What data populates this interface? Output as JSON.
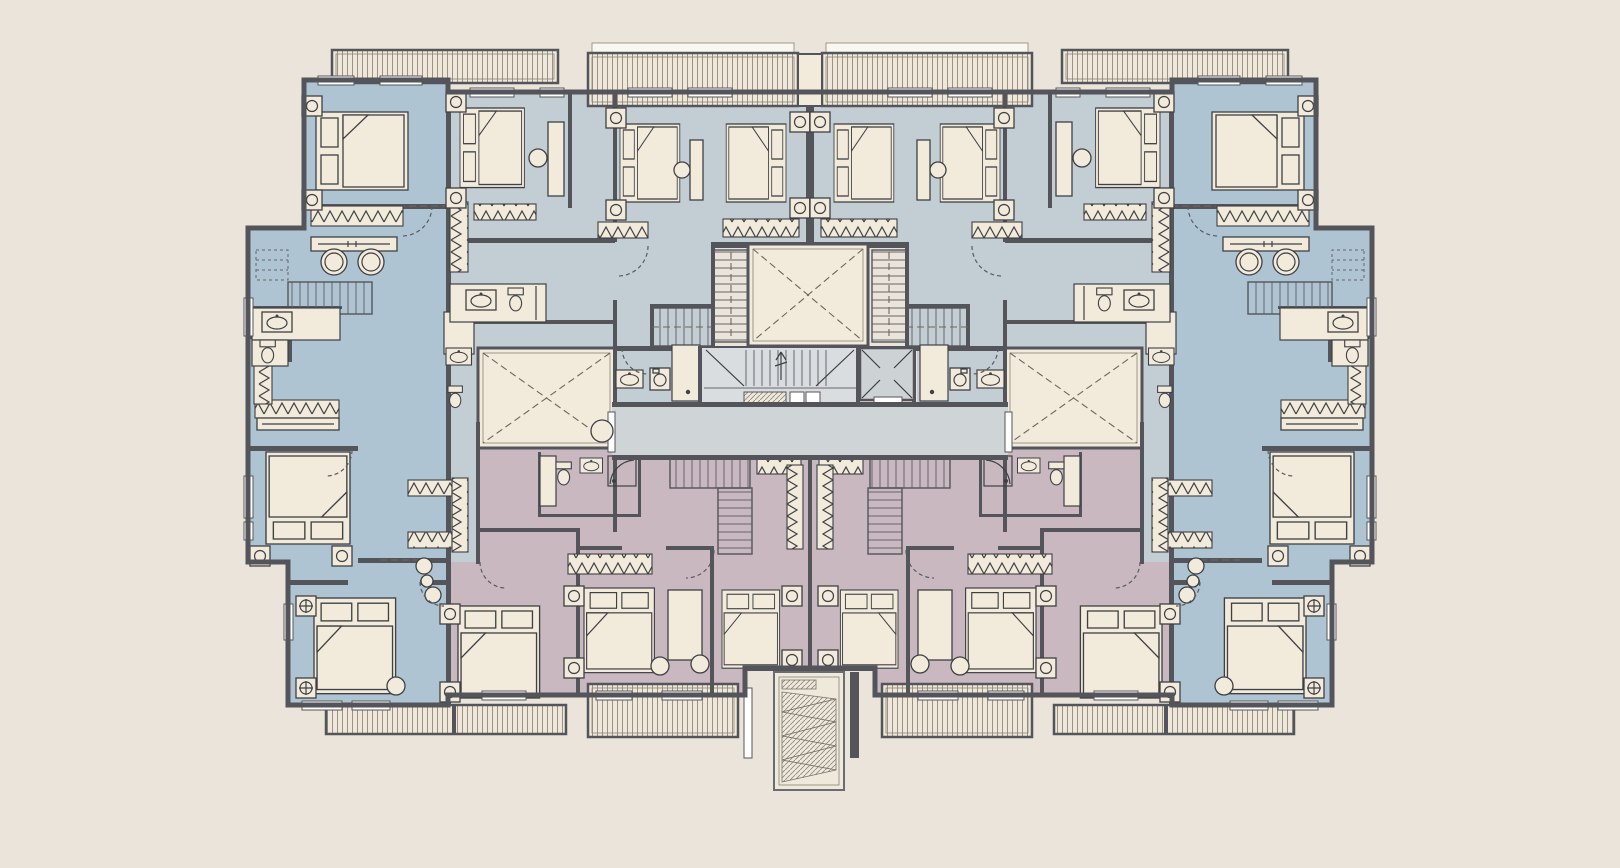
{
  "drawing": {
    "kind": "residential-apartment-floor-plan",
    "text_labels_visible": "none",
    "symmetry": "mirrored-about-vertical-center-axis"
  },
  "palette": {
    "bg": "#EAE4DA",
    "wall": "#54555B",
    "blue_corner": "#AFC4D3",
    "blue_mid": "#C3CDD4",
    "pink": "#C9B8C0",
    "cream": "#F2EADB",
    "corridor": "#CFD4D7",
    "stair_fill": "#DADDE0",
    "elevator_car": "#CDD2D5",
    "balcony_bg": "#EFE8DA",
    "balcony_line": "#9A9385",
    "furniture_line": "#3E4044",
    "dash_line": "#6E675B",
    "ramp_line": "#8F8B82"
  },
  "zones": [
    {
      "id": "unit-blue-left-wing",
      "fill": "#AFC4D3"
    },
    {
      "id": "units-top-middle",
      "fill": "#C3CDD4"
    },
    {
      "id": "units-bottom-middle-pink",
      "fill": "#C9B8C0"
    },
    {
      "id": "unit-blue-right-wing",
      "fill": "#AFC4D3"
    },
    {
      "id": "circulation-corridor",
      "fill": "#CFD4D7"
    },
    {
      "id": "shaft-light-well",
      "fill": "#F2EADB"
    }
  ],
  "features": [
    "light-well-with-dashed-x",
    "side-light-wells",
    "central-staircase",
    "elevator",
    "flanking-stairs",
    "corridor",
    "entrance-ramp",
    "hatched-balconies",
    "bedrooms-with-beds",
    "wardrobes-zigzag",
    "bathrooms",
    "dining-tables",
    "desks",
    "door-swing-arcs",
    "windows"
  ]
}
